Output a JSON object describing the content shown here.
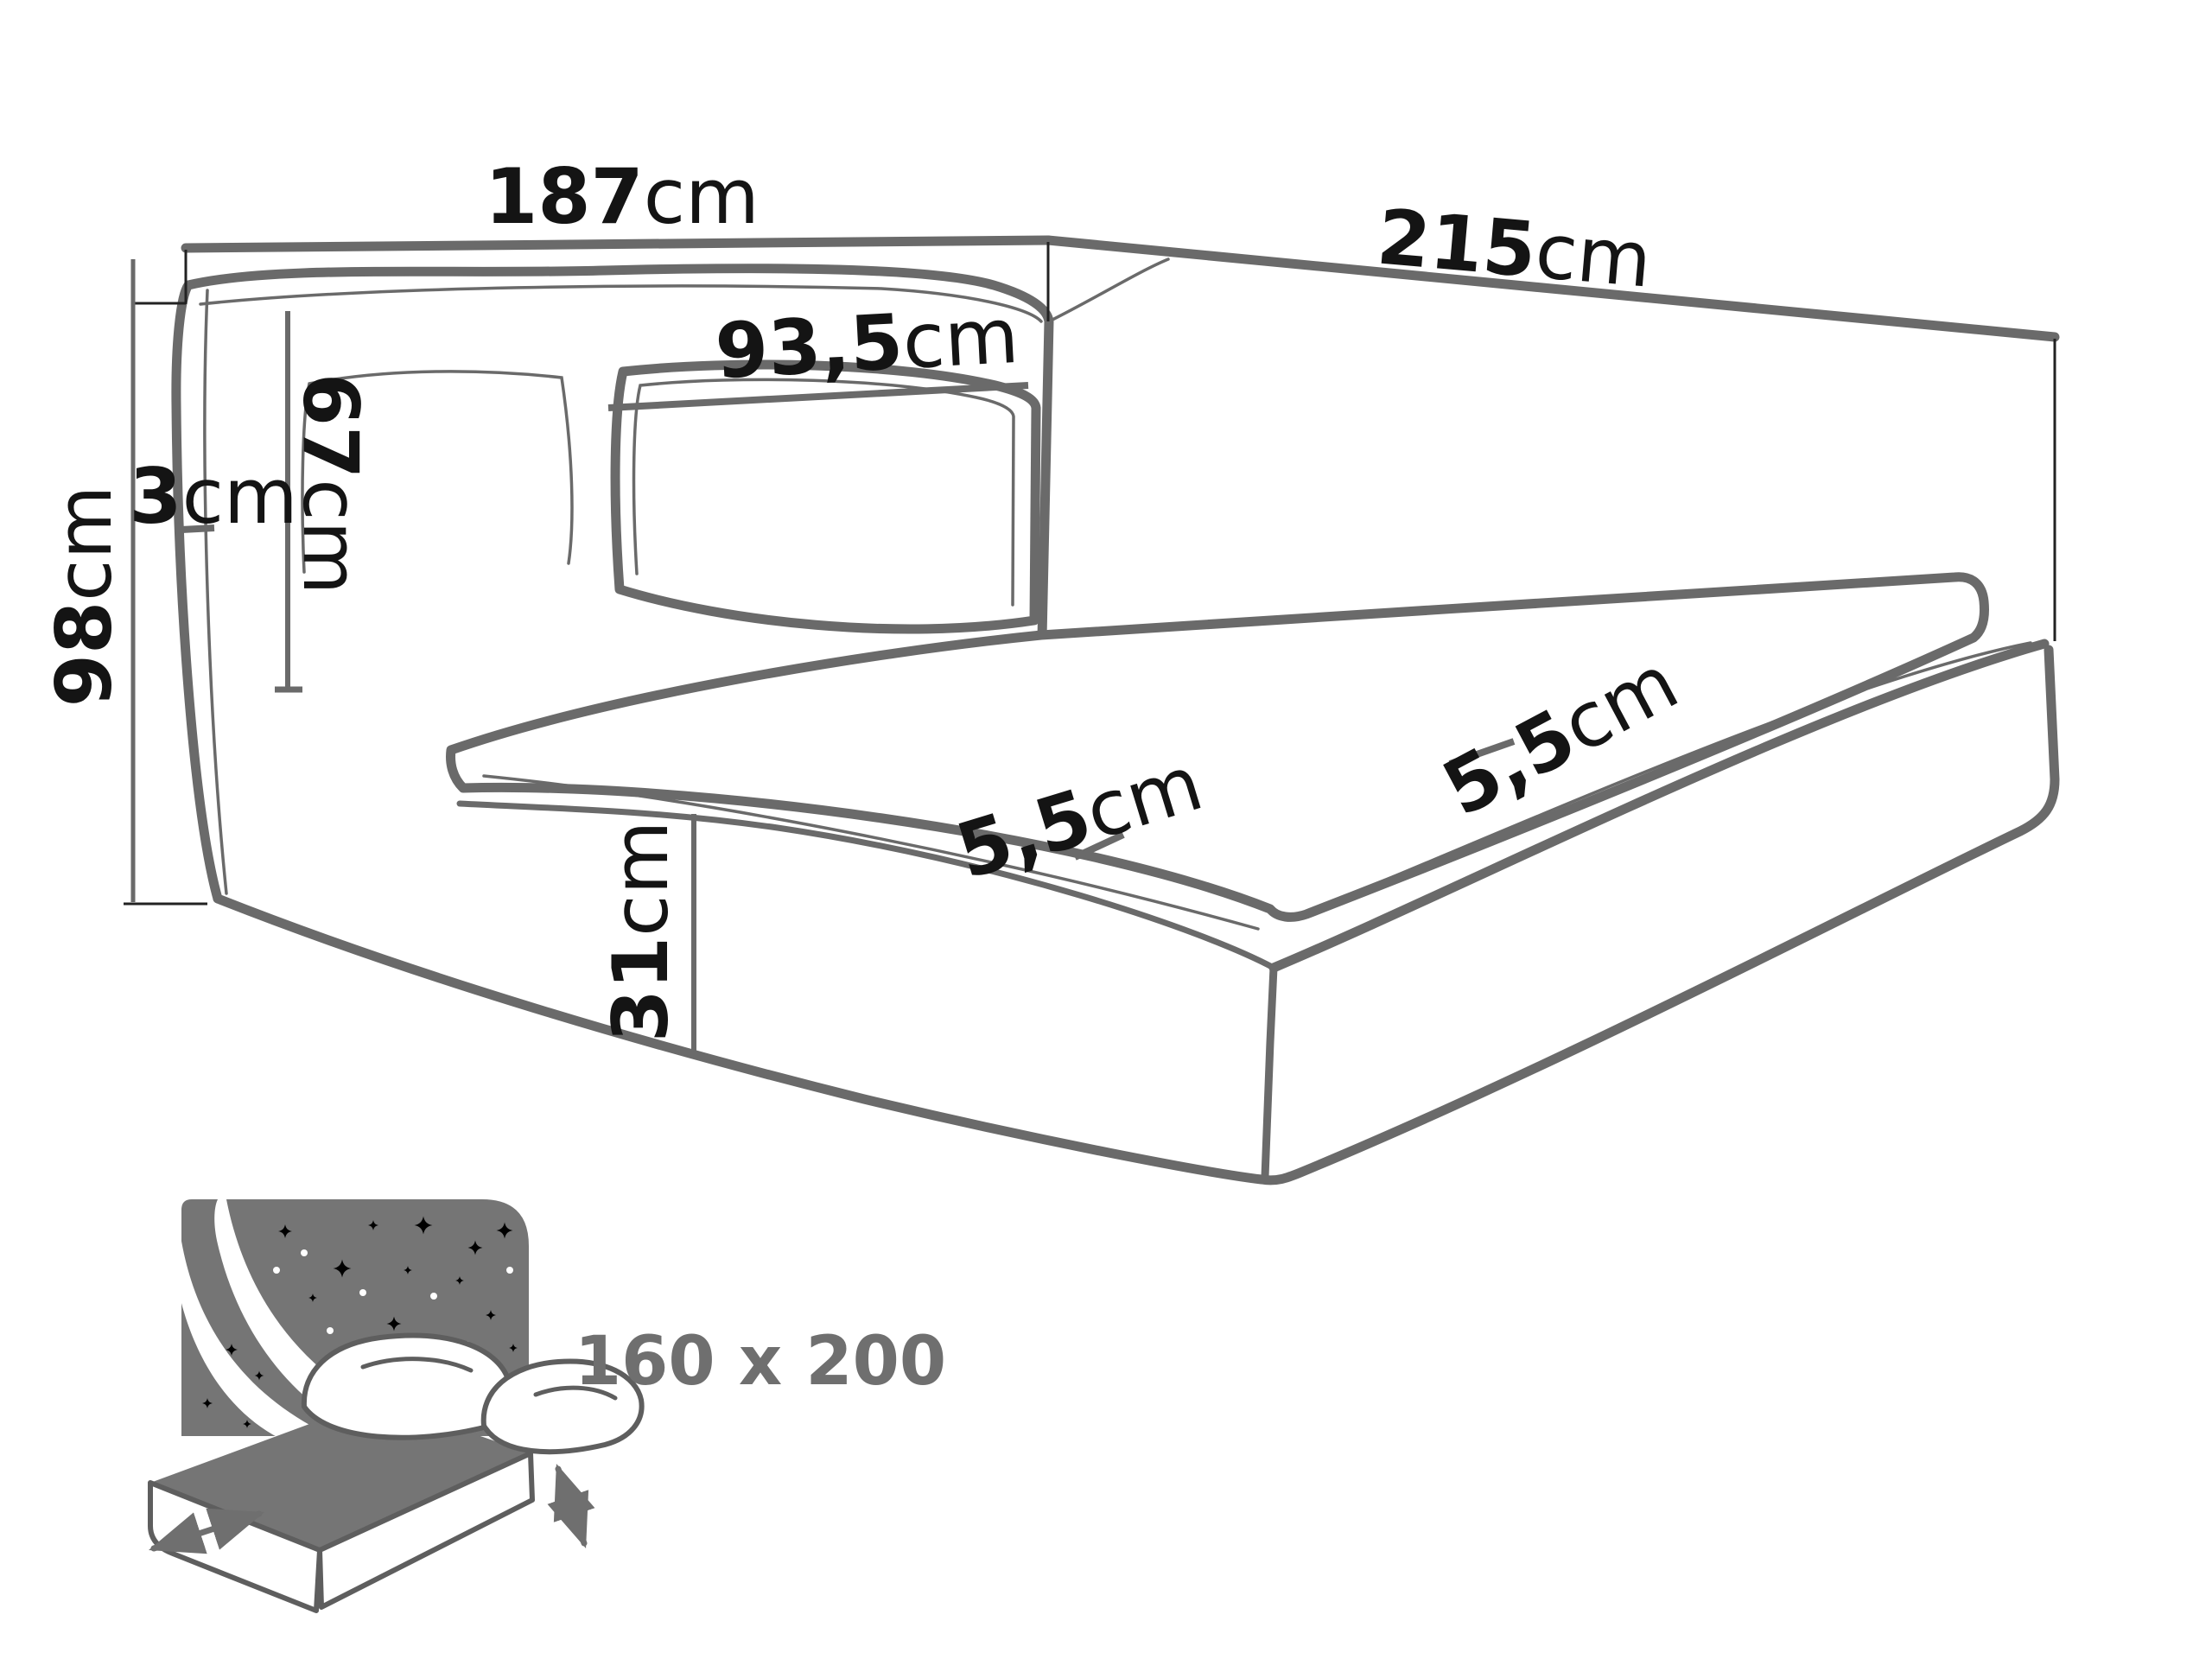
{
  "figure": {
    "type": "furniture-dimension-diagram",
    "unit": "cm"
  },
  "dimensions": {
    "headboard_width": {
      "value": "187",
      "unit": "cm"
    },
    "side_depth": {
      "value": "215",
      "unit": "cm"
    },
    "headboard_panel_width": {
      "value": "93,5",
      "unit": "cm"
    },
    "headboard_cushion_height": {
      "value": "67",
      "unit": "cm"
    },
    "side_wing_thickness": {
      "value": "3",
      "unit": "cm"
    },
    "headboard_total_height": {
      "value": "98",
      "unit": "cm"
    },
    "frame_height": {
      "value": "31",
      "unit": "cm"
    },
    "frame_lip_front": {
      "value": "5,5",
      "unit": "cm"
    },
    "frame_lip_side": {
      "value": "5,5",
      "unit": "cm"
    }
  },
  "badge": {
    "mattress_size": "160 x 200"
  },
  "colors": {
    "line": "#6a6a6a",
    "text": "#141414",
    "muted": "#6f6f6f",
    "icon": "#757575",
    "background": "#ffffff"
  }
}
